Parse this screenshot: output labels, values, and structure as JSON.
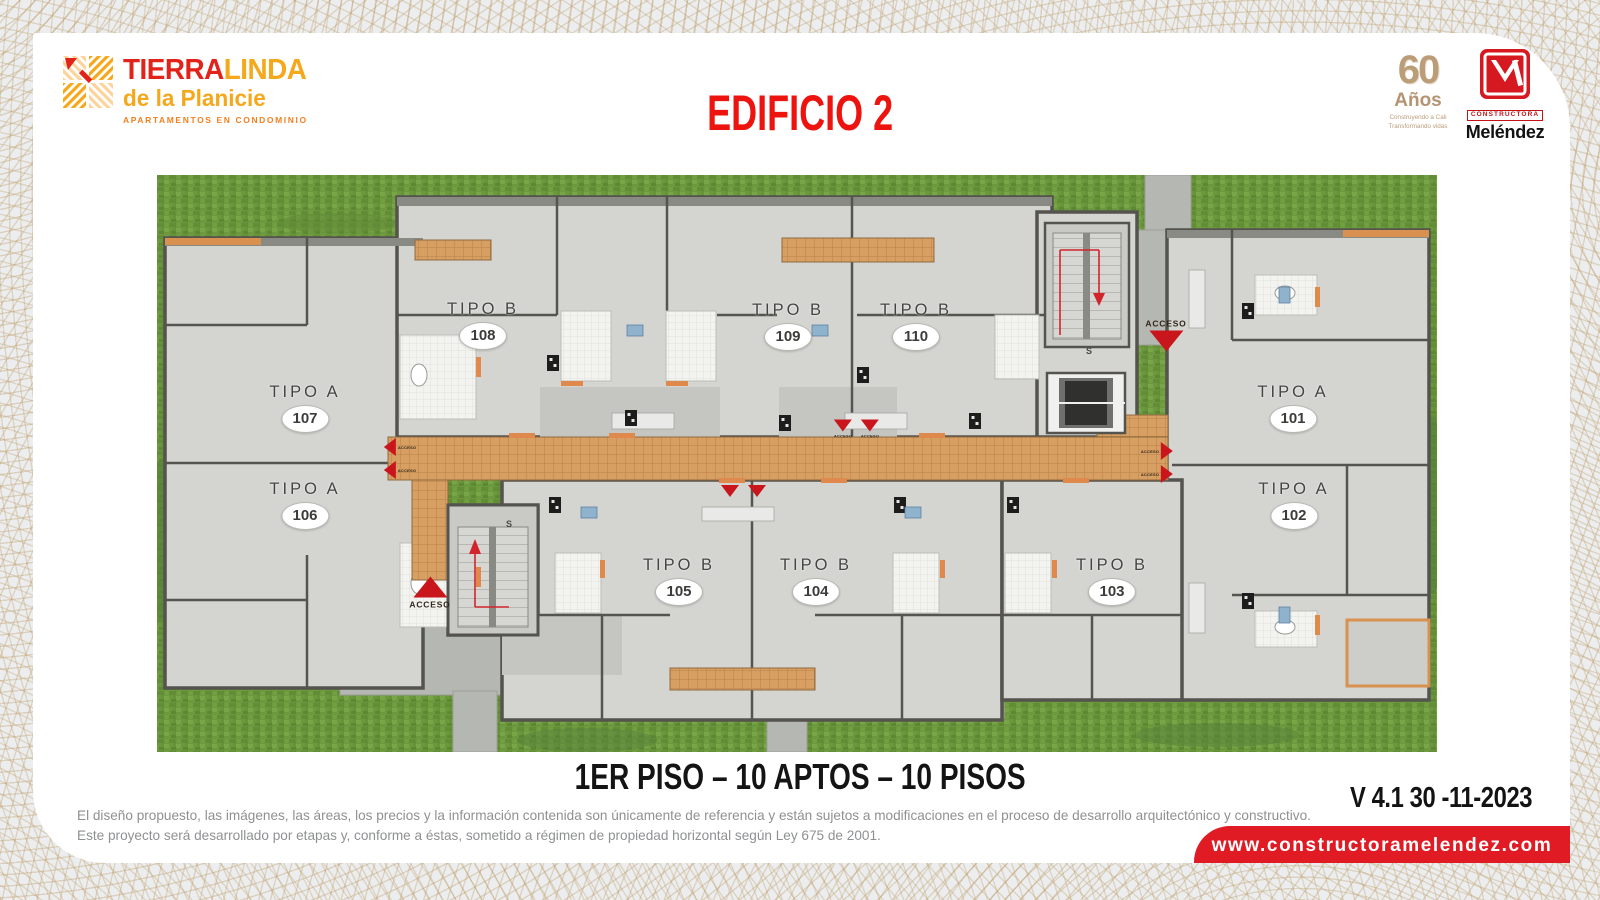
{
  "brand": {
    "name_primary": "TIERRA",
    "name_secondary": "LINDA",
    "subtitle": "de la Planicie",
    "tagline": "APARTAMENTOS EN CONDOMINIO"
  },
  "header": {
    "title": "EDIFICIO 2"
  },
  "logos": {
    "anniversary": {
      "number": "60",
      "label": "Años",
      "tagline1": "Construyendo a Cali",
      "tagline2": "Transformando vidas"
    },
    "builder": {
      "top": "CONSTRUCTORA",
      "name": "Meléndez"
    }
  },
  "plan": {
    "access_label": "ACCESO",
    "stair_label": "S",
    "units": [
      {
        "tipo": "TIPO B",
        "number": "108",
        "x": 326,
        "y": 150
      },
      {
        "tipo": "TIPO B",
        "number": "109",
        "x": 631,
        "y": 151
      },
      {
        "tipo": "TIPO B",
        "number": "110",
        "x": 759,
        "y": 151
      },
      {
        "tipo": "TIPO A",
        "number": "107",
        "x": 148,
        "y": 233
      },
      {
        "tipo": "TIPO A",
        "number": "101",
        "x": 1136,
        "y": 233
      },
      {
        "tipo": "TIPO A",
        "number": "106",
        "x": 148,
        "y": 330
      },
      {
        "tipo": "TIPO A",
        "number": "102",
        "x": 1137,
        "y": 330
      },
      {
        "tipo": "TIPO B",
        "number": "105",
        "x": 522,
        "y": 406
      },
      {
        "tipo": "TIPO B",
        "number": "104",
        "x": 659,
        "y": 406
      },
      {
        "tipo": "TIPO B",
        "number": "103",
        "x": 955,
        "y": 406
      }
    ],
    "stairs": [
      {
        "x": 352,
        "y": 349
      },
      {
        "x": 932,
        "y": 176
      }
    ],
    "markers": [
      {
        "x": 273,
        "y": 418,
        "dir": "up",
        "size": "lg",
        "label": "below"
      },
      {
        "x": 1009,
        "y": 160,
        "dir": "down",
        "size": "lg",
        "label": "above"
      },
      {
        "x": 243,
        "y": 272,
        "dir": "left",
        "size": "sm",
        "label": "right"
      },
      {
        "x": 243,
        "y": 295,
        "dir": "left",
        "size": "sm",
        "label": "right"
      },
      {
        "x": 686,
        "y": 254,
        "dir": "down",
        "size": "sm",
        "label": "right"
      },
      {
        "x": 713,
        "y": 254,
        "dir": "down",
        "size": "sm",
        "label": "right"
      },
      {
        "x": 573,
        "y": 316,
        "dir": "down",
        "size": "sm",
        "label": "none"
      },
      {
        "x": 600,
        "y": 316,
        "dir": "down",
        "size": "sm",
        "label": "none"
      },
      {
        "x": 1000,
        "y": 276,
        "dir": "right",
        "size": "sm",
        "label": "left"
      },
      {
        "x": 1000,
        "y": 299,
        "dir": "right",
        "size": "sm",
        "label": "left"
      }
    ]
  },
  "caption": "1ER PISO – 10 APTOS – 10 PISOS",
  "footer": {
    "version": "V 4.1 30 -11-2023",
    "disclaimer_line1": "El diseño propuesto, las imágenes, las áreas, los precios y la información contenida son únicamente de referencia y están sujetos a modificaciones en el proceso de desarrollo arquitectónico y constructivo.",
    "disclaimer_line2": "Este proyecto será desarrollado por etapas y, conforme a éstas, sometido a régimen de propiedad horizontal según Ley 675 de 2001.",
    "website": "www.constructoramelendez.com"
  },
  "colors": {
    "title_red": "#ed1410",
    "banner_red": "#e01b24",
    "brand_red": "#e2231a",
    "brand_orange": "#f5a81c",
    "gold": "#b49472",
    "grass_green": "#6c993e",
    "corridor_orange": "#d79f62"
  }
}
